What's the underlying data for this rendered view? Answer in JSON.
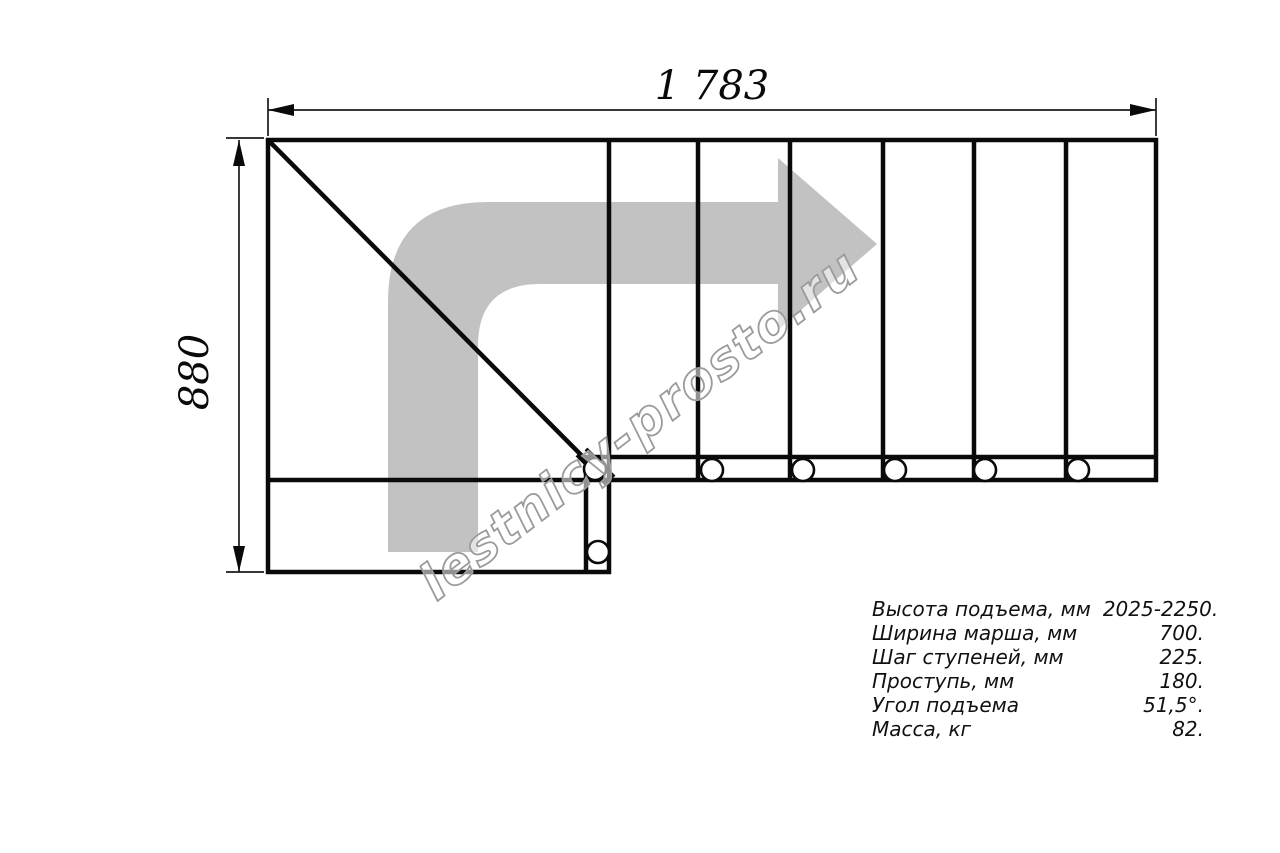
{
  "drawing": {
    "top_dimension_label": "1 783",
    "left_dimension_label": "880",
    "watermark_text": "lestnicy-prosto.ru"
  },
  "icons": {
    "direction_arrow": "turn-right-arrow"
  },
  "colors": {
    "line": "#0a0a0a",
    "arrow_gray": "#c2c2c2",
    "watermark_gray": "#9b9b9b",
    "background": "#ffffff"
  },
  "specs": {
    "rows": [
      {
        "label": "Высота подъема, мм",
        "value": "2025-2250."
      },
      {
        "label": "Ширина марша, мм",
        "value": "700."
      },
      {
        "label": "Шаг ступеней, мм",
        "value": "225."
      },
      {
        "label": "Проступь, мм",
        "value": "180."
      },
      {
        "label": "Угол подъема",
        "value": "51,5°."
      },
      {
        "label": "Масса, кг",
        "value": "82."
      }
    ]
  }
}
